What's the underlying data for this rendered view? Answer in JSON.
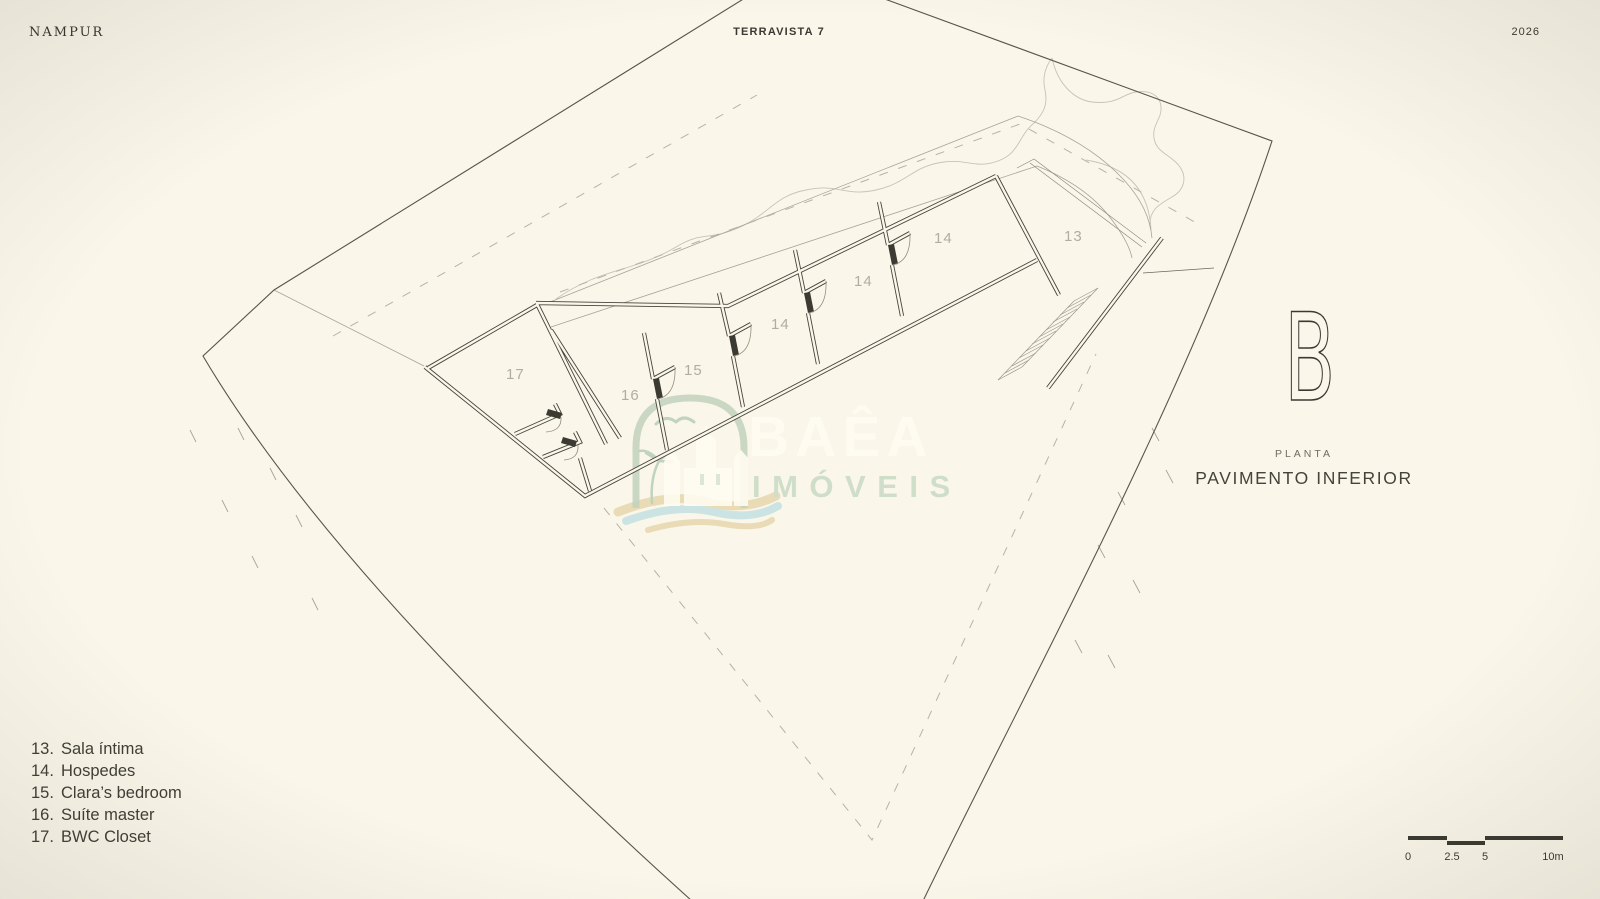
{
  "header": {
    "brand": "NAMPUR",
    "project": "TERRAVISTA 7",
    "year": "2026"
  },
  "plan": {
    "room_labels": [
      "17",
      "16",
      "15",
      "14",
      "14",
      "14",
      "13"
    ]
  },
  "legend": {
    "items": [
      {
        "num": "13.",
        "label": "Sala íntima"
      },
      {
        "num": "14.",
        "label": "Hospedes"
      },
      {
        "num": "15.",
        "label": "Clara’s bedroom"
      },
      {
        "num": "16.",
        "label": "Suíte master"
      },
      {
        "num": "17.",
        "label": "BWC Closet"
      }
    ]
  },
  "panel": {
    "letter": "B",
    "kicker": "PLANTA",
    "title": "PAVIMENTO INFERIOR"
  },
  "watermark": {
    "line1": "BAÊA",
    "line2": "IMÓVEIS"
  },
  "scalebar": {
    "labels": [
      "0",
      "2.5",
      "5",
      "10m"
    ]
  },
  "colors": {
    "background": "#faf6e9",
    "wall_ink": "#46453c",
    "boundary": "#57564b",
    "muted_label": "#b2ae9e",
    "logo_green": "#b7cdb5",
    "wave_sand": "#e6d7ae",
    "wave_blue": "#c3e1e3"
  }
}
